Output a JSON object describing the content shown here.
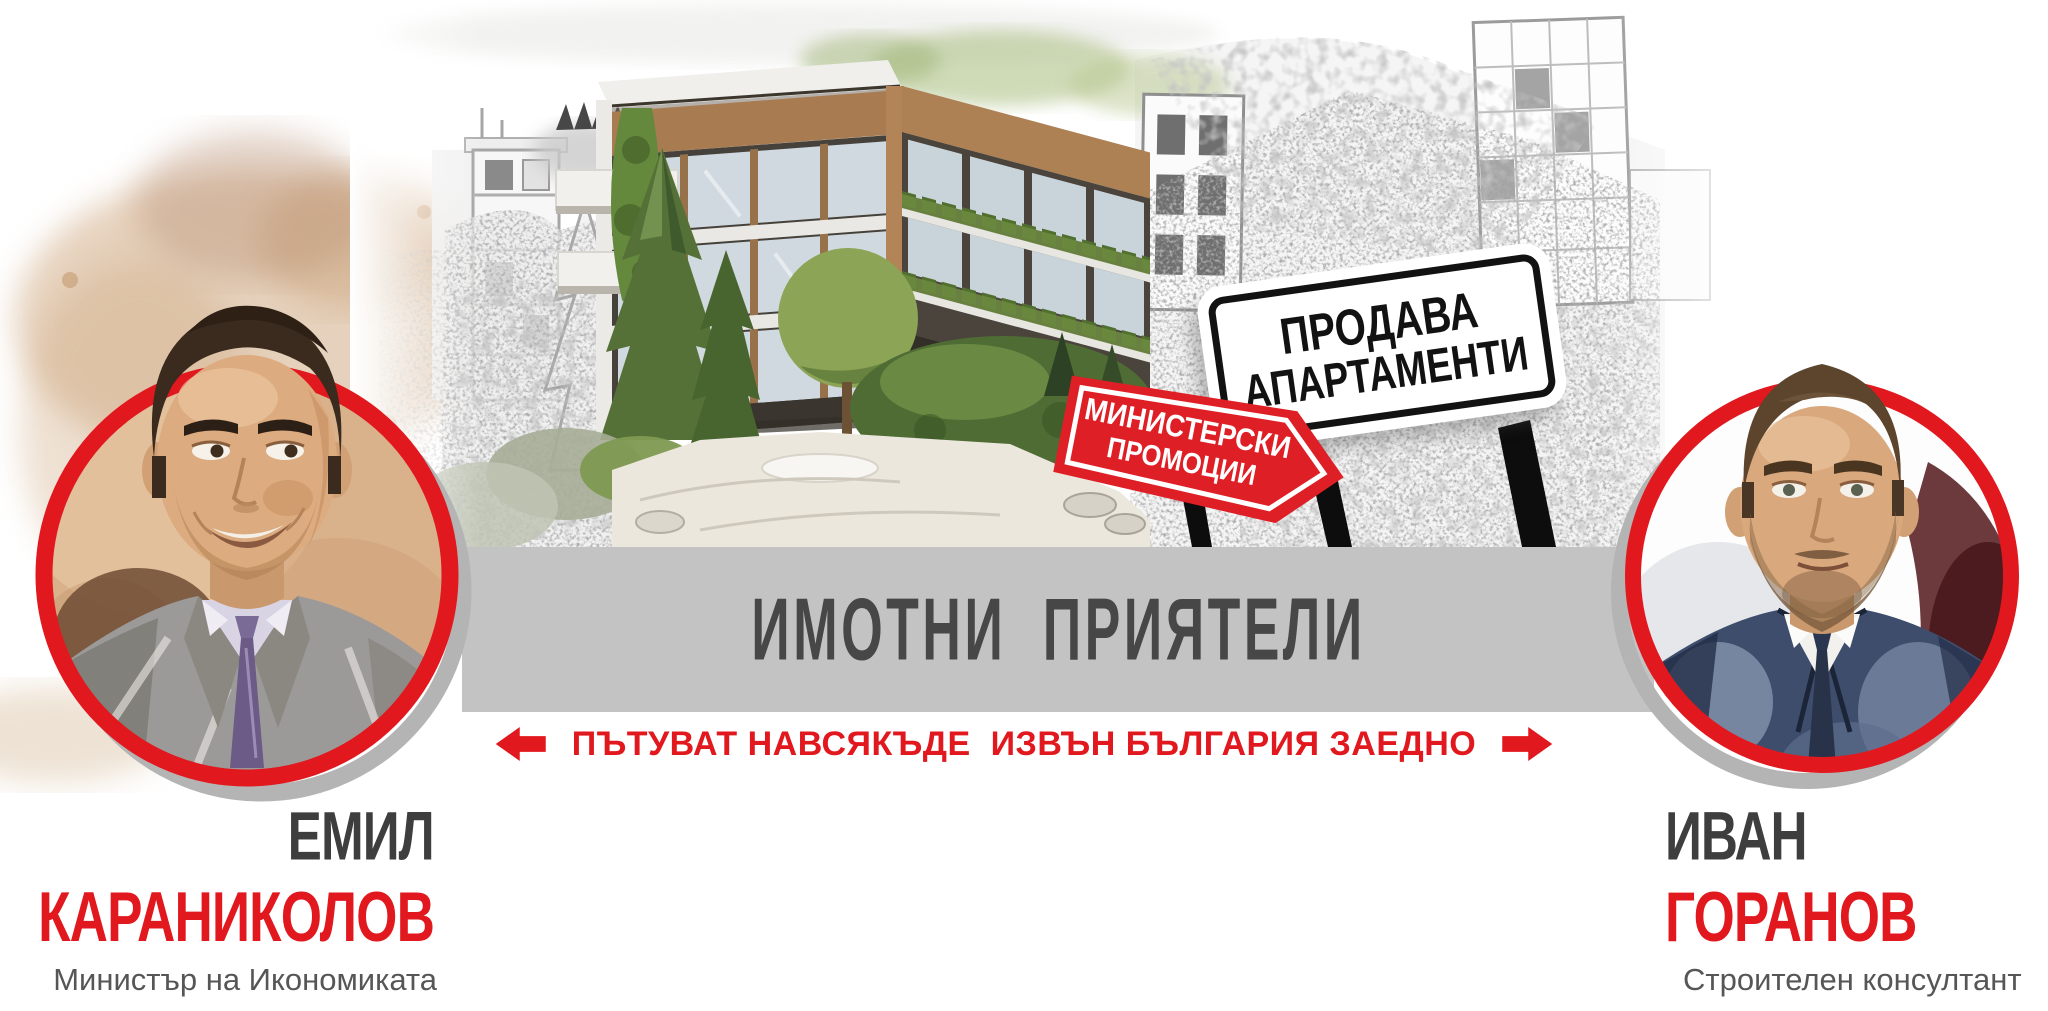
{
  "colors": {
    "accent_red": "#e2181f",
    "banner_bg": "#c3c3c3",
    "banner_text": "#474747",
    "name_dark": "#3e3e3e",
    "subtitle_gray": "#565656",
    "sign_red": "#df1f26",
    "sign_border_black": "#121212"
  },
  "banner": {
    "title": "ИМОТНИ  ПРИЯТЕЛИ"
  },
  "tagline": {
    "text": "ПЪТУВАТ НАВСЯКЪДЕ  ИЗВЪН БЪЛГАРИЯ ЗАЕДНО"
  },
  "signs": {
    "sale_sign": {
      "line1": "ПРОДАВА",
      "line2": "АПАРТАМЕНТИ"
    },
    "promo_sign": {
      "line1": "МИНИСТЕРСКИ",
      "line2": "ПРОМОЦИИ"
    }
  },
  "people": {
    "left": {
      "first_name": "ЕМИЛ",
      "last_name": "КАРАНИКОЛОВ",
      "role": "Министър на Икономиката"
    },
    "right": {
      "first_name": "ИВАН",
      "last_name": "ГОРАНОВ",
      "role": "Строителен консултант"
    }
  }
}
